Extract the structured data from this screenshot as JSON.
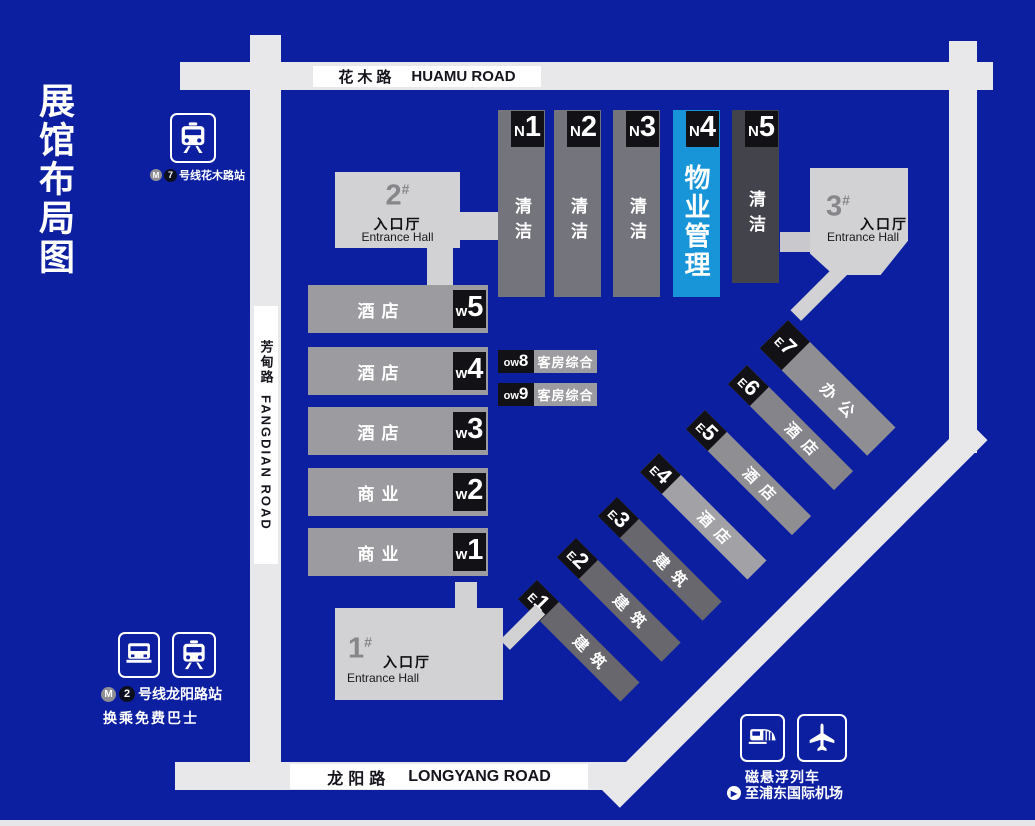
{
  "title": "展馆布局图",
  "roads": {
    "huamu": {
      "zh": "花木路",
      "en": "HUAMU ROAD"
    },
    "fangdian": {
      "zh": "芳甸路",
      "en": "FANGDIAN ROAD"
    },
    "longyang": {
      "zh": "龙阳路",
      "en": "LONGYANG ROAD"
    }
  },
  "transit": {
    "metro7": {
      "line_num": "7",
      "station": "号线花木路站"
    },
    "metro2": {
      "line_num": "2",
      "station": "号线龙阳路站",
      "note": "换乘免费巴士"
    },
    "maglev": {
      "name": "磁悬浮列车",
      "dest": "至浦东国际机场"
    }
  },
  "entrances": [
    {
      "num": "1",
      "hash": "#",
      "zh": "入口厅",
      "en": "Entrance Hall"
    },
    {
      "num": "2",
      "hash": "#",
      "zh": "入口厅",
      "en": "Entrance Hall"
    },
    {
      "num": "3",
      "hash": "#",
      "zh": "入口厅",
      "en": "Entrance Hall"
    }
  ],
  "north_halls": [
    {
      "label_prefix": "N",
      "label_num": "1",
      "use": "清洁"
    },
    {
      "label_prefix": "N",
      "label_num": "2",
      "use": "清洁"
    },
    {
      "label_prefix": "N",
      "label_num": "3",
      "use": "清洁"
    },
    {
      "label_prefix": "N",
      "label_num": "4",
      "use": "物业管理",
      "highlight": true
    },
    {
      "label_prefix": "N",
      "label_num": "5",
      "use": "清洁"
    }
  ],
  "west_halls": [
    {
      "label_prefix": "w",
      "label_num": "5",
      "use": "酒店"
    },
    {
      "label_prefix": "w",
      "label_num": "4",
      "use": "酒店"
    },
    {
      "label_prefix": "w",
      "label_num": "3",
      "use": "酒店"
    },
    {
      "label_prefix": "w",
      "label_num": "2",
      "use": "商业"
    },
    {
      "label_prefix": "w",
      "label_num": "1",
      "use": "商业"
    }
  ],
  "annex_halls": [
    {
      "label_prefix": "ow",
      "label_num": "8",
      "use": "客房综合"
    },
    {
      "label_prefix": "ow",
      "label_num": "9",
      "use": "客房综合"
    }
  ],
  "east_halls": [
    {
      "label_prefix": "E",
      "label_num": "1",
      "use": "建筑"
    },
    {
      "label_prefix": "E",
      "label_num": "2",
      "use": "建筑"
    },
    {
      "label_prefix": "E",
      "label_num": "3",
      "use": "建筑"
    },
    {
      "label_prefix": "E",
      "label_num": "4",
      "use": "酒店"
    },
    {
      "label_prefix": "E",
      "label_num": "5",
      "use": "酒店"
    },
    {
      "label_prefix": "E",
      "label_num": "6",
      "use": "酒店"
    },
    {
      "label_prefix": "E",
      "label_num": "7",
      "use": "办公"
    }
  ],
  "icons": {
    "metro_logo": "M",
    "play": "▶"
  },
  "colors": {
    "background": "#0c1fa0",
    "road": "#e8e8ea",
    "road_label_bg": "#ffffff",
    "highlight_hall": "#1795d8",
    "hall_gray_north": "#74747c",
    "hall_gray_n5": "#43434b",
    "hall_gray_west": "#9c9ca0",
    "hall_gray_east_123": "#67676d",
    "hall_gray_east_4": "#a2a2a6",
    "entrance_hall": "#d2d2d5",
    "tag_black": "#121216"
  }
}
